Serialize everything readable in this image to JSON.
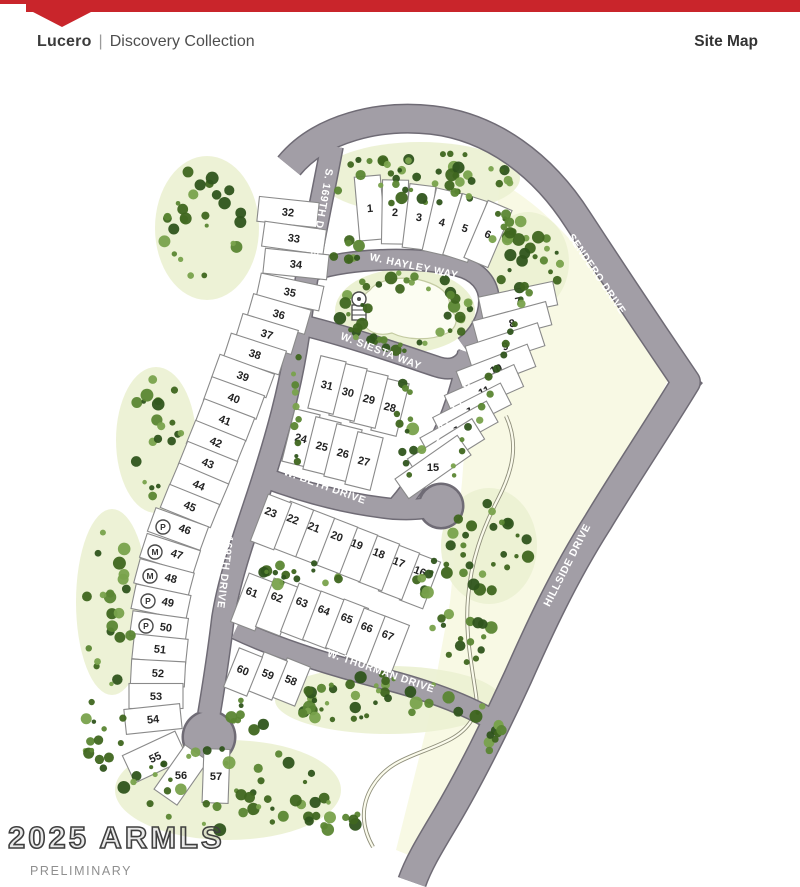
{
  "header": {
    "brand": "Lucero",
    "divider": "|",
    "collection": "Discovery Collection",
    "page_label": "Site Map",
    "accent_color": "#c9252b"
  },
  "footer": {
    "watermark": "2025 ARMLS",
    "status": "PRELIMINARY"
  },
  "map": {
    "colors": {
      "road": "#a29ea6",
      "road_edge": "#6f6b75",
      "cream": "#f8f9e4",
      "bed": "#ebf1d2",
      "lot_fill": "#ffffff",
      "lot_line": "#8a8a8a",
      "lot_num": "#222222",
      "label": "#ffffff",
      "wash_dark": "#8f8f7b",
      "wash_light": "#fbfbec",
      "pond": "#fcfdf2",
      "pond_edge": "#c4cba2",
      "greens": [
        "#3f661f",
        "#5b8633",
        "#79a24c",
        "#2f541c"
      ]
    },
    "open_space": "M 500,182 C 558,214 610,280 668,380 L 598,520 L 518,676 L 458,790 L 416,858 L 396,850 L 428,722 L 450,602 L 462,482 L 468,402 L 470,356 C 488,300 494,240 500,182 Z",
    "roads": [
      {
        "id": "boundary-road",
        "d": "M 289,166 C 320,128 380,114 432,120 C 492,127 543,165 578,220 C 612,272 652,332 686,382 C 658,428 622,482 598,522 C 563,577 538,632 518,677 C 497,723 470,777 447,816 C 431,843 419,862 412,882",
        "w": 27
      },
      {
        "id": "s-169th-drive",
        "d": "M 332,146 C 320,210 308,262 300,322 C 292,385 276,440 258,495 C 243,540 229,580 223,618 C 219,652 214,684 209,714",
        "w": 21
      },
      {
        "id": "w-hayley-way",
        "d": "M 314,270 C 358,257 420,257 458,266 C 478,271 489,284 489,301 C 489,319 478,337 464,347",
        "w": 19
      },
      {
        "id": "w-siesta-way",
        "d": "M 306,326 C 350,337 402,355 438,367 C 457,373 466,361 469,353",
        "w": 19
      },
      {
        "id": "168th-lane",
        "d": "M 468,352 C 462,392 446,434 426,467 C 415,485 405,498 397,507",
        "w": 19
      },
      {
        "id": "w-beth-drive",
        "d": "M 263,477 C 308,494 354,505 394,509 C 412,510 425,509 434,506",
        "w": 19
      },
      {
        "id": "w-thurman-drive",
        "d": "M 236,629 C 278,649 330,665 380,678 C 432,691 476,708 503,727",
        "w": 19
      }
    ],
    "corner_bulge": "M 664,350 L 703,383 L 668,422 L 683,385 Z",
    "culdesacs": [
      {
        "x": 209,
        "y": 737,
        "r": 25
      },
      {
        "x": 441,
        "y": 506,
        "r": 21
      }
    ],
    "road_labels": [
      {
        "text": "S. 169TH DRIVE",
        "x": 322,
        "y": 212,
        "rot": 100
      },
      {
        "text": "S. 169TH DRIVE",
        "x": 226,
        "y": 565,
        "rot": 97
      },
      {
        "text": "W. HAYLEY WAY",
        "x": 414,
        "y": 266,
        "rot": 12
      },
      {
        "text": "W. SIESTA WAY",
        "x": 381,
        "y": 351,
        "rot": 21
      },
      {
        "text": "168TH LANE",
        "x": 452,
        "y": 412,
        "rot": -58
      },
      {
        "text": "SENDERO DRIVE",
        "x": 597,
        "y": 274,
        "rot": 56
      },
      {
        "text": "HILLSIDE DRIVE",
        "x": 567,
        "y": 565,
        "rot": -63
      },
      {
        "text": "W. BETH DRIVE",
        "x": 325,
        "y": 486,
        "rot": 20
      },
      {
        "text": "W. THURMAN DRIVE",
        "x": 381,
        "y": 671,
        "rot": 19
      }
    ],
    "washes": [
      "M 506,416 C 519,444 513,470 498,499 C 482,530 471,561 468,598 C 465,632 471,661 476,695 C 479,714 469,729 451,739 C 419,756 390,757 372,787 C 360,807 362,828 373,847"
    ],
    "park": {
      "bed": {
        "cx": 405,
        "cy": 311,
        "rx": 70,
        "ry": 42
      },
      "pond": "M 370,290 C 378,279 404,275 424,281 C 444,287 452,297 449,310 C 460,315 458,329 445,334 C 430,341 406,340 392,333 C 377,337 364,331 363,319 C 356,310 360,297 370,290 Z",
      "icon": {
        "x": 359,
        "y": 299
      }
    },
    "lots": [
      {
        "n": "1",
        "x": 370,
        "y": 208,
        "rot": -5,
        "w": 26,
        "h": 64
      },
      {
        "n": "2",
        "x": 395,
        "y": 212,
        "rot": 1,
        "w": 26,
        "h": 64
      },
      {
        "n": "3",
        "x": 419,
        "y": 217,
        "rot": 7,
        "w": 26,
        "h": 64
      },
      {
        "n": "4",
        "x": 442,
        "y": 222,
        "rot": 13,
        "w": 26,
        "h": 64
      },
      {
        "n": "5",
        "x": 465,
        "y": 228,
        "rot": 18,
        "w": 26,
        "h": 64
      },
      {
        "n": "6",
        "x": 488,
        "y": 234,
        "rot": 23,
        "w": 26,
        "h": 62
      },
      {
        "n": "7",
        "x": 518,
        "y": 301,
        "rot": -12,
        "w": 76,
        "h": 24
      },
      {
        "n": "8",
        "x": 512,
        "y": 323,
        "rot": -15,
        "w": 76,
        "h": 24
      },
      {
        "n": "9",
        "x": 505,
        "y": 346,
        "rot": -18,
        "w": 76,
        "h": 24
      },
      {
        "n": "10",
        "x": 496,
        "y": 369,
        "rot": -21,
        "w": 76,
        "h": 24
      },
      {
        "n": "11",
        "x": 484,
        "y": 391,
        "rot": -24,
        "w": 76,
        "h": 24
      },
      {
        "n": "12",
        "x": 472,
        "y": 411,
        "rot": -27,
        "w": 76,
        "h": 24
      },
      {
        "n": "13",
        "x": 459,
        "y": 430,
        "rot": -29,
        "w": 76,
        "h": 24
      },
      {
        "n": "14",
        "x": 446,
        "y": 449,
        "rot": -32,
        "w": 76,
        "h": 24
      },
      {
        "n": "15",
        "x": 433,
        "y": 467,
        "rot": -35,
        "w": 76,
        "h": 24
      },
      {
        "n": "16",
        "x": 420,
        "y": 581,
        "rot": 21,
        "w": 25,
        "h": 50,
        "ty": -10
      },
      {
        "n": "17",
        "x": 399,
        "y": 572,
        "rot": 21,
        "w": 25,
        "h": 50,
        "ty": -10
      },
      {
        "n": "18",
        "x": 379,
        "y": 563,
        "rot": 21,
        "w": 25,
        "h": 50,
        "ty": -10
      },
      {
        "n": "19",
        "x": 357,
        "y": 554,
        "rot": 21,
        "w": 25,
        "h": 50,
        "ty": -10
      },
      {
        "n": "20",
        "x": 337,
        "y": 546,
        "rot": 21,
        "w": 25,
        "h": 50,
        "ty": -10
      },
      {
        "n": "21",
        "x": 314,
        "y": 537,
        "rot": 21,
        "w": 25,
        "h": 50,
        "ty": -10
      },
      {
        "n": "22",
        "x": 293,
        "y": 529,
        "rot": 21,
        "w": 25,
        "h": 50,
        "ty": -10
      },
      {
        "n": "23",
        "x": 271,
        "y": 522,
        "rot": 21,
        "w": 25,
        "h": 50,
        "ty": -10
      },
      {
        "n": "24",
        "x": 301,
        "y": 438,
        "rot": 14,
        "w": 26,
        "h": 54
      },
      {
        "n": "25",
        "x": 322,
        "y": 446,
        "rot": 14,
        "w": 26,
        "h": 54
      },
      {
        "n": "26",
        "x": 343,
        "y": 453,
        "rot": 14,
        "w": 26,
        "h": 54
      },
      {
        "n": "27",
        "x": 364,
        "y": 461,
        "rot": 14,
        "w": 26,
        "h": 54
      },
      {
        "n": "28",
        "x": 390,
        "y": 407,
        "rot": 14,
        "w": 26,
        "h": 54
      },
      {
        "n": "29",
        "x": 369,
        "y": 399,
        "rot": 14,
        "w": 26,
        "h": 54
      },
      {
        "n": "30",
        "x": 348,
        "y": 392,
        "rot": 14,
        "w": 26,
        "h": 54
      },
      {
        "n": "31",
        "x": 327,
        "y": 385,
        "rot": 14,
        "w": 26,
        "h": 54
      },
      {
        "n": "32",
        "x": 288,
        "y": 212,
        "rot": 6,
        "w": 60,
        "h": 25
      },
      {
        "n": "33",
        "x": 294,
        "y": 238,
        "rot": 8,
        "w": 62,
        "h": 25
      },
      {
        "n": "34",
        "x": 296,
        "y": 264,
        "rot": 6,
        "w": 64,
        "h": 25
      },
      {
        "n": "35",
        "x": 290,
        "y": 292,
        "rot": 12,
        "w": 64,
        "h": 25
      },
      {
        "n": "36",
        "x": 279,
        "y": 314,
        "rot": 16,
        "w": 60,
        "h": 25
      },
      {
        "n": "37",
        "x": 267,
        "y": 334,
        "rot": 17,
        "w": 58,
        "h": 25
      },
      {
        "n": "38",
        "x": 255,
        "y": 354,
        "rot": 18,
        "w": 58,
        "h": 25
      },
      {
        "n": "39",
        "x": 243,
        "y": 376,
        "rot": 20,
        "w": 58,
        "h": 25
      },
      {
        "n": "40",
        "x": 234,
        "y": 398,
        "rot": 20,
        "w": 56,
        "h": 25
      },
      {
        "n": "41",
        "x": 225,
        "y": 420,
        "rot": 21,
        "w": 54,
        "h": 25
      },
      {
        "n": "42",
        "x": 216,
        "y": 442,
        "rot": 22,
        "w": 54,
        "h": 25
      },
      {
        "n": "43",
        "x": 208,
        "y": 463,
        "rot": 22,
        "w": 54,
        "h": 25
      },
      {
        "n": "44",
        "x": 199,
        "y": 485,
        "rot": 23,
        "w": 54,
        "h": 25
      },
      {
        "n": "45",
        "x": 190,
        "y": 506,
        "rot": 22,
        "w": 54,
        "h": 25
      },
      {
        "n": "46",
        "x": 178,
        "y": 529,
        "rot": 20,
        "w": 56,
        "h": 25,
        "tx": 7
      },
      {
        "n": "47",
        "x": 170,
        "y": 554,
        "rot": 18,
        "w": 56,
        "h": 25,
        "tx": 7
      },
      {
        "n": "48",
        "x": 164,
        "y": 578,
        "rot": 15,
        "w": 56,
        "h": 25,
        "tx": 7
      },
      {
        "n": "49",
        "x": 161,
        "y": 602,
        "rot": 12,
        "w": 56,
        "h": 25,
        "tx": 7
      },
      {
        "n": "50",
        "x": 159,
        "y": 627,
        "rot": 8,
        "w": 56,
        "h": 25,
        "tx": 7
      },
      {
        "n": "51",
        "x": 160,
        "y": 649,
        "rot": 6,
        "w": 54,
        "h": 25
      },
      {
        "n": "52",
        "x": 158,
        "y": 673,
        "rot": 3,
        "w": 54,
        "h": 25
      },
      {
        "n": "53",
        "x": 156,
        "y": 696,
        "rot": 0,
        "w": 54,
        "h": 25
      },
      {
        "n": "54",
        "x": 153,
        "y": 719,
        "rot": -6,
        "w": 56,
        "h": 25
      },
      {
        "n": "55",
        "x": 155,
        "y": 757,
        "rot": -25,
        "w": 58,
        "h": 30
      },
      {
        "n": "56",
        "x": 181,
        "y": 775,
        "rot": -55,
        "w": 54,
        "h": 28
      },
      {
        "n": "57",
        "x": 216,
        "y": 776,
        "rot": -88,
        "w": 54,
        "h": 26
      },
      {
        "n": "58",
        "x": 291,
        "y": 682,
        "rot": 22,
        "w": 25,
        "h": 42,
        "ty": -2
      },
      {
        "n": "59",
        "x": 268,
        "y": 676,
        "rot": 22,
        "w": 25,
        "h": 42,
        "ty": -2
      },
      {
        "n": "60",
        "x": 243,
        "y": 672,
        "rot": 22,
        "w": 25,
        "h": 42,
        "ty": -2
      },
      {
        "n": "61",
        "x": 252,
        "y": 602,
        "rot": 21,
        "w": 26,
        "h": 52,
        "ty": -10
      },
      {
        "n": "62",
        "x": 277,
        "y": 607,
        "rot": 21,
        "w": 26,
        "h": 52,
        "ty": -10
      },
      {
        "n": "63",
        "x": 302,
        "y": 612,
        "rot": 21,
        "w": 26,
        "h": 52,
        "ty": -10
      },
      {
        "n": "64",
        "x": 324,
        "y": 620,
        "rot": 21,
        "w": 26,
        "h": 52,
        "ty": -10
      },
      {
        "n": "65",
        "x": 347,
        "y": 628,
        "rot": 21,
        "w": 26,
        "h": 52,
        "ty": -10
      },
      {
        "n": "66",
        "x": 367,
        "y": 637,
        "rot": 21,
        "w": 26,
        "h": 52,
        "ty": -10
      },
      {
        "n": "67",
        "x": 388,
        "y": 645,
        "rot": 21,
        "w": 26,
        "h": 52,
        "ty": -10
      }
    ],
    "badges": [
      {
        "t": "P",
        "x": 163,
        "y": 527
      },
      {
        "t": "M",
        "x": 155,
        "y": 552
      },
      {
        "t": "M",
        "x": 150,
        "y": 576
      },
      {
        "t": "P",
        "x": 148,
        "y": 601
      },
      {
        "t": "P",
        "x": 146,
        "y": 626
      }
    ],
    "tree_clusters": [
      {
        "cx": 420,
        "cy": 178,
        "rx": 92,
        "ry": 28,
        "n": 48,
        "seed": 1,
        "bed": true
      },
      {
        "cx": 528,
        "cy": 262,
        "rx": 33,
        "ry": 42,
        "n": 22,
        "seed": 2,
        "bed": true
      },
      {
        "cx": 505,
        "cy": 222,
        "rx": 20,
        "ry": 24,
        "n": 10,
        "seed": 22,
        "bed": false
      },
      {
        "cx": 207,
        "cy": 228,
        "rx": 44,
        "ry": 64,
        "n": 26,
        "seed": 3,
        "bed": true
      },
      {
        "cx": 156,
        "cy": 440,
        "rx": 32,
        "ry": 65,
        "n": 20,
        "seed": 4,
        "bed": true
      },
      {
        "cx": 112,
        "cy": 602,
        "rx": 28,
        "ry": 85,
        "n": 22,
        "seed": 5,
        "bed": true
      },
      {
        "cx": 405,
        "cy": 312,
        "rx": 66,
        "ry": 40,
        "n": 46,
        "seed": 6,
        "ring": true
      },
      {
        "cx": 409,
        "cy": 428,
        "rx": 15,
        "ry": 50,
        "n": 13,
        "seed": 7
      },
      {
        "cx": 300,
        "cy": 575,
        "rx": 58,
        "ry": 12,
        "n": 16,
        "seed": 8
      },
      {
        "cx": 437,
        "cy": 592,
        "rx": 22,
        "ry": 38,
        "n": 14,
        "seed": 9
      },
      {
        "cx": 489,
        "cy": 546,
        "rx": 40,
        "ry": 50,
        "n": 26,
        "seed": 10,
        "bed": true
      },
      {
        "cx": 470,
        "cy": 640,
        "rx": 25,
        "ry": 30,
        "n": 12,
        "seed": 20
      },
      {
        "cx": 388,
        "cy": 700,
        "rx": 105,
        "ry": 26,
        "n": 40,
        "seed": 11,
        "bed": true
      },
      {
        "cx": 497,
        "cy": 722,
        "rx": 24,
        "ry": 32,
        "n": 12,
        "seed": 12
      },
      {
        "cx": 228,
        "cy": 790,
        "rx": 105,
        "ry": 42,
        "n": 40,
        "seed": 13,
        "bed": true
      },
      {
        "cx": 104,
        "cy": 733,
        "rx": 22,
        "ry": 40,
        "n": 14,
        "seed": 14
      },
      {
        "cx": 250,
        "cy": 714,
        "rx": 20,
        "ry": 22,
        "n": 8,
        "seed": 21
      },
      {
        "cx": 322,
        "cy": 812,
        "rx": 42,
        "ry": 22,
        "n": 14,
        "seed": 15
      },
      {
        "cx": 345,
        "cy": 250,
        "rx": 18,
        "ry": 14,
        "n": 8,
        "seed": 18
      }
    ],
    "tree_lines": [
      {
        "x1": 528,
        "y1": 296,
        "x2": 450,
        "y2": 478,
        "n": 16,
        "seed": 16
      },
      {
        "x1": 297,
        "y1": 360,
        "x2": 299,
        "y2": 465,
        "n": 10,
        "seed": 17
      }
    ]
  }
}
